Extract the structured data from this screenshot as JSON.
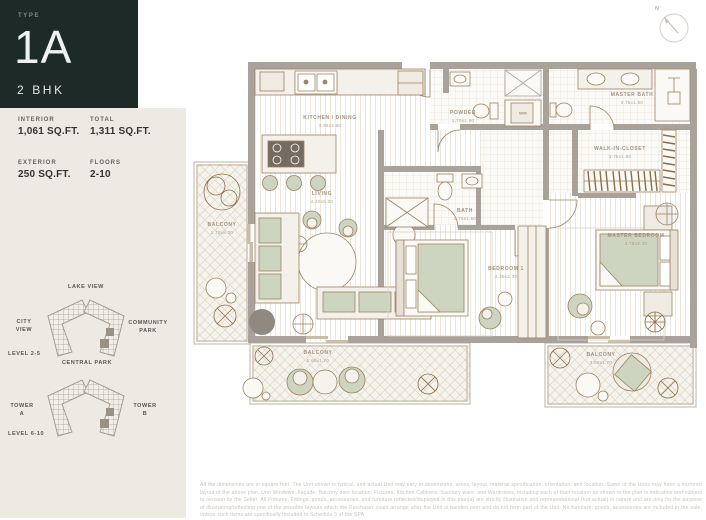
{
  "type_card": {
    "label": "TYPE",
    "code": "1A",
    "subtitle": "2 BHK",
    "bg": "#1d2a27"
  },
  "stats": [
    {
      "label": "INTERIOR",
      "value": "1,061 SQ.FT."
    },
    {
      "label": "TOTAL",
      "value": "1,311 SQ.FT."
    },
    {
      "label": "EXTERIOR",
      "value": "250 SQ.FT."
    },
    {
      "label": "FLOORS",
      "value": "2-10"
    }
  ],
  "site_maps": [
    {
      "top": "LAKE VIEW",
      "left": "CITY VIEW",
      "right": "COMMUNITY PARK",
      "level": "LEVEL 2-5",
      "bottom": "CENTRAL PARK"
    },
    {
      "left": "TOWER A",
      "right": "TOWER B",
      "level": "LEVEL 6-10"
    }
  ],
  "compass": {
    "north_label": "N"
  },
  "plan": {
    "rooms": [
      {
        "name": "KITCHEN / DINING",
        "dims": "3.95x2.80"
      },
      {
        "name": "POWDER",
        "dims": "1.70x1.50"
      },
      {
        "name": "MASTER BATH",
        "dims": "3.75x1.50"
      },
      {
        "name": "WALK-IN-CLOSET",
        "dims": "3.75x1.80"
      },
      {
        "name": "LIVING",
        "dims": "4.40x5.00"
      },
      {
        "name": "BATH",
        "dims": "2.70x1.50"
      },
      {
        "name": "BEDROOM 1",
        "dims": "4.30x3.30"
      },
      {
        "name": "MASTER BEDROOM",
        "dims": "3.75x4.30"
      },
      {
        "name": "BALCONY",
        "dims": "1.70x8.30"
      },
      {
        "name": "BALCONY",
        "dims": "5.60x1.70"
      },
      {
        "name": "BALCONY",
        "dims": "3.50x1.70"
      }
    ],
    "appliances": {
      "washer": "WM"
    }
  },
  "colors": {
    "accent_dark": "#1d2a27",
    "panel_beige": "#edeae3",
    "wall_gray": "#a9a29b",
    "line_tan": "#9b8363",
    "green": "#cdd4bf"
  },
  "disclaimer": "All the dimensions are in square feet. The Unit shown is typical, and actual Unit may vary in dimensions, areas, layout, material specification, orientation, and location. Some of the Units may have a mirrored layout of the above plan. Unit Windows, Façade, Balcony door location, Fixtures, Kitchen Cabinets, Sanitary ware, and Wardrobes, including each of their location as shown in the plan is indicative and subject to revision by the Seller. All Fixtures, Fittings, goods, accessories, and furniture reflected/displayed in this plan(s) are strictly illustrative and representational (not actual) in nature and are only for the purpose of illustrating/reflecting one of the possible layouts which the Purchaser could arrange after the Unit is handed over and do not form part of the Unit. No furniture, goods, accessories are included in the sale, unless such items are specifically included in Schedule 3 of the SPA."
}
